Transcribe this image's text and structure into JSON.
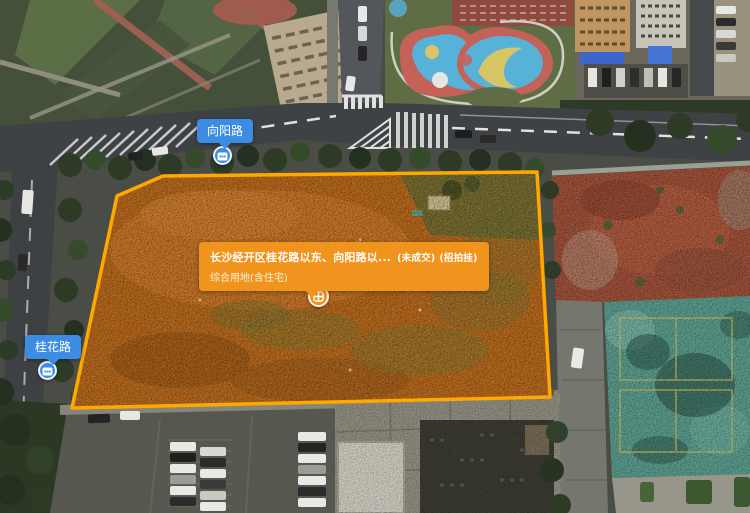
{
  "page": {
    "width": 750,
    "height": 513,
    "view": "aerial-land-parcel-map"
  },
  "colors": {
    "parcel_outline": "#FFA800",
    "parcel_fill_tint": "rgba(255,170,0,0.07)",
    "tooltip_bg": "#F0941E",
    "road_label_bg": "#3D8CE4"
  },
  "road_labels": [
    {
      "name": "向阳路"
    },
    {
      "name": "桂花路"
    }
  ],
  "parcel_tooltip": {
    "title": "长沙经开区桂花路以东、向阳路以...",
    "status": "(未成交)",
    "listing_type": "(招拍挂)",
    "land_use": "综合用地(含住宅)"
  },
  "icons": {
    "parcel_marker": "land-block-grid-icon",
    "road_marker": "road-sign-icon"
  }
}
